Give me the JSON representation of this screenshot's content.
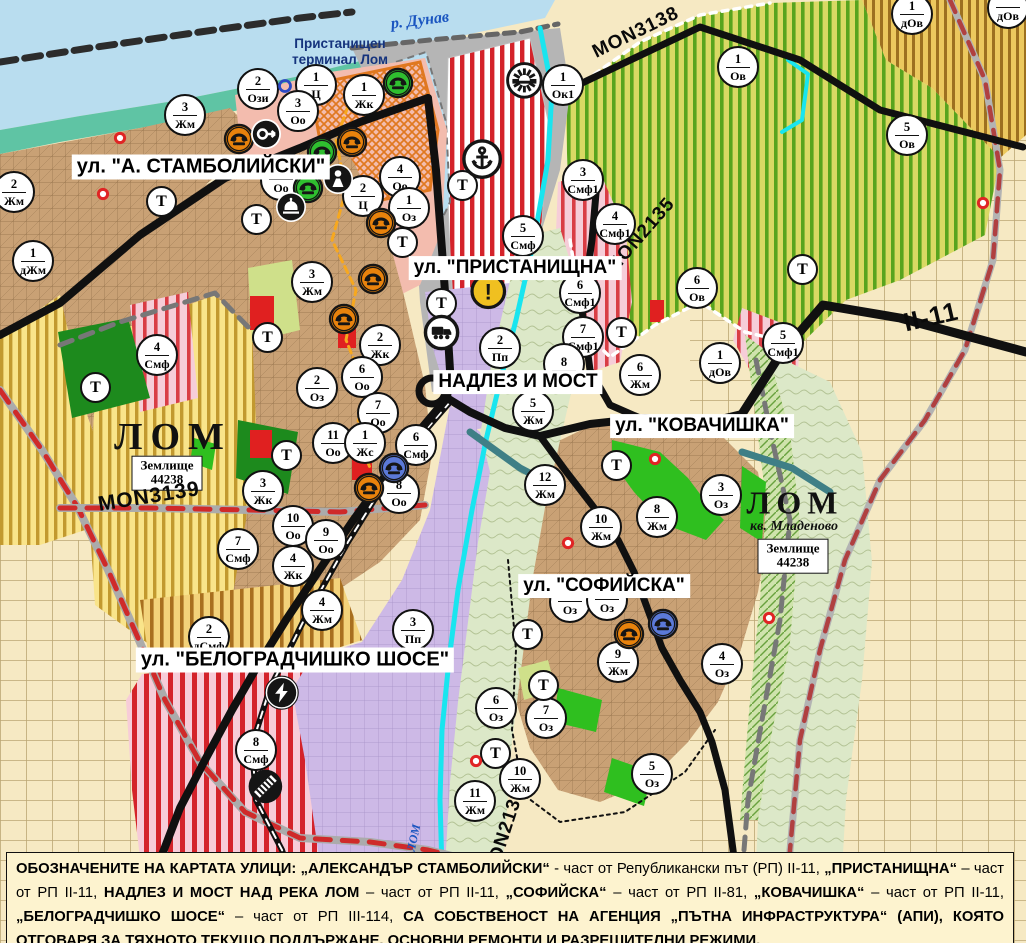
{
  "map": {
    "water_labels": {
      "danube": "р. Дунав",
      "lom_river": "ЛОМ"
    },
    "terminal_label": {
      "line1": "Пристанищен",
      "line2": "терминал Лом"
    },
    "street_labels": [
      {
        "text": "ул. \"А. СТАМБОЛИЙСКИ\"",
        "x": 201,
        "y": 167,
        "fs": 20
      },
      {
        "text": "ул. \"ПРИСТАНИЩНА\"",
        "x": 515,
        "y": 268,
        "fs": 19
      },
      {
        "text": "НАДЛЕЗ И МОСТ",
        "x": 518,
        "y": 382,
        "fs": 19
      },
      {
        "text": "ул. \"КОВАЧИШКА\"",
        "x": 702,
        "y": 426,
        "fs": 19
      },
      {
        "text": "ул. \"СОФИЙСКА\"",
        "x": 604,
        "y": 586,
        "fs": 19
      },
      {
        "text": "ул. \"БЕЛОГРАДЧИШКО ШОСЕ\"",
        "x": 295,
        "y": 660,
        "fs": 20
      }
    ],
    "road_labels": [
      {
        "text": "MON3139",
        "x": 149,
        "y": 497,
        "rot": -9,
        "fs": 21
      },
      {
        "text": "MON3138",
        "x": 636,
        "y": 33,
        "rot": -26,
        "fs": 19
      },
      {
        "text": "MON2135",
        "x": 641,
        "y": 236,
        "rot": -49,
        "fs": 19
      },
      {
        "text": "II-11",
        "x": 931,
        "y": 317,
        "rot": -13,
        "fs": 26
      },
      {
        "text": "MON2136",
        "x": 505,
        "y": 833,
        "rot": -72,
        "fs": 19
      }
    ],
    "city_west": {
      "name": "ЛОМ",
      "land_line1": "Землище",
      "land_line2": "44238"
    },
    "city_east": {
      "name": "ЛОМ",
      "district": "кв. Младеново",
      "land_line1": "Землище",
      "land_line2": "44238"
    },
    "zone_markers": [
      {
        "n": "2",
        "code": "Ози",
        "x": 258,
        "y": 89
      },
      {
        "n": "1",
        "code": "Ц",
        "x": 316,
        "y": 85
      },
      {
        "n": "3",
        "code": "Оо",
        "x": 298,
        "y": 111
      },
      {
        "n": "1",
        "code": "Жк",
        "x": 364,
        "y": 95
      },
      {
        "n": "3",
        "code": "Жм",
        "x": 185,
        "y": 115
      },
      {
        "n": "2",
        "code": "Жм",
        "x": 14,
        "y": 192
      },
      {
        "n": "1",
        "code": "дЖм",
        "x": 33,
        "y": 261
      },
      {
        "n": "",
        "code": "Оо",
        "x": 281,
        "y": 180
      },
      {
        "n": "4",
        "code": "Оо",
        "x": 400,
        "y": 177
      },
      {
        "n": "2",
        "code": "Ц",
        "x": 363,
        "y": 196
      },
      {
        "n": "1",
        "code": "Оз",
        "x": 409,
        "y": 208
      },
      {
        "n": "1",
        "code": "Ок1",
        "x": 563,
        "y": 85
      },
      {
        "n": "1",
        "code": "дОв",
        "x": 912,
        "y": 14
      },
      {
        "n": "",
        "code": "дОв",
        "x": 1008,
        "y": 8
      },
      {
        "n": "1",
        "code": "Ов",
        "x": 738,
        "y": 67
      },
      {
        "n": "5",
        "code": "Ов",
        "x": 907,
        "y": 135
      },
      {
        "n": "3",
        "code": "Смф1",
        "x": 583,
        "y": 180
      },
      {
        "n": "4",
        "code": "Смф1",
        "x": 615,
        "y": 224
      },
      {
        "n": "5",
        "code": "Смф",
        "x": 523,
        "y": 236
      },
      {
        "n": "6",
        "code": "Смф1",
        "x": 580,
        "y": 293
      },
      {
        "n": "7",
        "code": "Смф1",
        "x": 583,
        "y": 337
      },
      {
        "n": "6",
        "code": "Ов",
        "x": 697,
        "y": 288
      },
      {
        "n": "1",
        "code": "дОв",
        "x": 720,
        "y": 363
      },
      {
        "n": "5",
        "code": "Смф1",
        "x": 783,
        "y": 343
      },
      {
        "n": "3",
        "code": "Жм",
        "x": 312,
        "y": 282
      },
      {
        "n": "2",
        "code": "Жк",
        "x": 380,
        "y": 345
      },
      {
        "n": "2",
        "code": "Оз",
        "x": 317,
        "y": 388
      },
      {
        "n": "6",
        "code": "Оо",
        "x": 362,
        "y": 377
      },
      {
        "n": "7",
        "code": "Оо",
        "x": 378,
        "y": 413
      },
      {
        "n": "11",
        "code": "Оо",
        "x": 333,
        "y": 443
      },
      {
        "n": "1",
        "code": "Жс",
        "x": 365,
        "y": 443
      },
      {
        "n": "6",
        "code": "Смф",
        "x": 416,
        "y": 445
      },
      {
        "n": "8",
        "code": "Оо",
        "x": 399,
        "y": 493
      },
      {
        "n": "3",
        "code": "Жк",
        "x": 263,
        "y": 491
      },
      {
        "n": "10",
        "code": "Оо",
        "x": 293,
        "y": 526
      },
      {
        "n": "9",
        "code": "Оо",
        "x": 326,
        "y": 540
      },
      {
        "n": "4",
        "code": "Жк",
        "x": 293,
        "y": 566
      },
      {
        "n": "7",
        "code": "Смф",
        "x": 238,
        "y": 549
      },
      {
        "n": "4",
        "code": "Смф",
        "x": 157,
        "y": 355
      },
      {
        "n": "2",
        "code": "Пп",
        "x": 500,
        "y": 348
      },
      {
        "n": "8",
        "code": "",
        "x": 564,
        "y": 364
      },
      {
        "n": "5",
        "code": "Жм",
        "x": 533,
        "y": 411
      },
      {
        "n": "12",
        "code": "Жм",
        "x": 545,
        "y": 485
      },
      {
        "n": "10",
        "code": "Жм",
        "x": 601,
        "y": 527
      },
      {
        "n": "8",
        "code": "Жм",
        "x": 657,
        "y": 517
      },
      {
        "n": "6",
        "code": "Жм",
        "x": 640,
        "y": 375
      },
      {
        "n": "3",
        "code": "Оз",
        "x": 721,
        "y": 495
      },
      {
        "n": "10",
        "code": "Жм",
        "x": 520,
        "y": 779
      },
      {
        "n": "11",
        "code": "Жм",
        "x": 475,
        "y": 801
      },
      {
        "n": "9",
        "code": "Жм",
        "x": 618,
        "y": 662
      },
      {
        "n": "6",
        "code": "Оз",
        "x": 496,
        "y": 708
      },
      {
        "n": "7",
        "code": "Оз",
        "x": 546,
        "y": 718
      },
      {
        "n": "5",
        "code": "Оз",
        "x": 652,
        "y": 774
      },
      {
        "n": "4",
        "code": "Оз",
        "x": 722,
        "y": 664
      },
      {
        "n": "8",
        "code": "Смф",
        "x": 256,
        "y": 750
      },
      {
        "n": "2",
        "code": "дСмф",
        "x": 209,
        "y": 637
      },
      {
        "n": "4",
        "code": "Жм",
        "x": 322,
        "y": 610
      },
      {
        "n": "3",
        "code": "Пп",
        "x": 413,
        "y": 630
      },
      {
        "n": "",
        "code": "Оз",
        "x": 570,
        "y": 602
      },
      {
        "n": "",
        "code": "Оз",
        "x": 607,
        "y": 600
      }
    ],
    "t_markers": [
      {
        "x": 162,
        "y": 202
      },
      {
        "x": 257,
        "y": 220
      },
      {
        "x": 403,
        "y": 243
      },
      {
        "x": 463,
        "y": 186
      },
      {
        "x": 442,
        "y": 304
      },
      {
        "x": 268,
        "y": 338
      },
      {
        "x": 96,
        "y": 388
      },
      {
        "x": 287,
        "y": 456
      },
      {
        "x": 622,
        "y": 333
      },
      {
        "x": 803,
        "y": 270
      },
      {
        "x": 617,
        "y": 466
      },
      {
        "x": 528,
        "y": 635
      },
      {
        "x": 544,
        "y": 686
      },
      {
        "x": 496,
        "y": 754
      }
    ],
    "icons": [
      {
        "kind": "monument",
        "color": "orange",
        "x": 239,
        "y": 139
      },
      {
        "kind": "monument",
        "color": "orange",
        "x": 352,
        "y": 142
      },
      {
        "kind": "monument",
        "color": "orange",
        "x": 381,
        "y": 223
      },
      {
        "kind": "monument",
        "color": "orange",
        "x": 373,
        "y": 279
      },
      {
        "kind": "monument",
        "color": "orange",
        "x": 344,
        "y": 319
      },
      {
        "kind": "monument",
        "color": "orange",
        "x": 369,
        "y": 488
      },
      {
        "kind": "monument",
        "color": "orange",
        "x": 629,
        "y": 634
      },
      {
        "kind": "monument",
        "color": "green",
        "x": 398,
        "y": 83
      },
      {
        "kind": "monument",
        "color": "green",
        "x": 322,
        "y": 152
      },
      {
        "kind": "monument",
        "color": "green",
        "x": 308,
        "y": 188
      },
      {
        "kind": "monument",
        "color": "blue",
        "x": 394,
        "y": 468
      },
      {
        "kind": "monument",
        "color": "blue",
        "x": 663,
        "y": 624
      },
      {
        "kind": "arrow",
        "x": 266,
        "y": 134
      },
      {
        "kind": "dome",
        "x": 291,
        "y": 207
      },
      {
        "kind": "person",
        "x": 338,
        "y": 179
      },
      {
        "kind": "anchor",
        "x": 482,
        "y": 159,
        "s": 1.3
      },
      {
        "kind": "sun",
        "x": 524,
        "y": 80,
        "s": 1.2
      },
      {
        "kind": "truck",
        "x": 442,
        "y": 333,
        "s": 1.15
      },
      {
        "kind": "lightning",
        "x": 282,
        "y": 693,
        "s": 1.1
      },
      {
        "kind": "railway",
        "x": 265,
        "y": 786,
        "s": 1.2
      },
      {
        "kind": "warning",
        "x": 488,
        "y": 291,
        "s": 1.25
      },
      {
        "kind": "bluering",
        "x": 285,
        "y": 86
      },
      {
        "kind": "reddot",
        "x": 120,
        "y": 138
      },
      {
        "kind": "reddot",
        "x": 103,
        "y": 194
      },
      {
        "kind": "reddot",
        "x": 568,
        "y": 543
      },
      {
        "kind": "reddot",
        "x": 655,
        "y": 459
      },
      {
        "kind": "reddot",
        "x": 476,
        "y": 761
      },
      {
        "kind": "reddot",
        "x": 983,
        "y": 203
      },
      {
        "kind": "reddot",
        "x": 769,
        "y": 618
      }
    ]
  },
  "note": {
    "segments": [
      {
        "t": "ОБОЗНАЧЕНИТЕ НА КАРТАТА УЛИЦИ: „АЛЕКСАНДЪР СТАМБОЛИЙСКИ“",
        "b": true
      },
      {
        "t": " - част от Републикански път (РП) II-11, ",
        "b": false
      },
      {
        "t": "„ПРИСТАНИЩНА“",
        "b": true
      },
      {
        "t": " – част от РП II-11, ",
        "b": false
      },
      {
        "t": "НАДЛЕЗ И МОСТ НАД РЕКА ЛОМ",
        "b": true
      },
      {
        "t": " – част от РП II-11, ",
        "b": false
      },
      {
        "t": "„СОФИЙСКА“",
        "b": true
      },
      {
        "t": " – част от РП II-81, ",
        "b": false
      },
      {
        "t": "„КОВАЧИШКА“",
        "b": true
      },
      {
        "t": " – част от РП II-11, ",
        "b": false
      },
      {
        "t": "„БЕЛОГРАДЧИШКО ШОСЕ“",
        "b": true
      },
      {
        "t": " – част от РП III-114, ",
        "b": false
      },
      {
        "t": "СА СОБСТВЕНОСТ НА АГЕНЦИЯ „ПЪТНА ИНФРАСТРУКТУРА“ (АПИ), КОЯТО ОТГОВАРЯ ЗА ТЯХНОТО ТЕКУЩО ПОДДЪРЖАНЕ, ОСНОВНИ РЕМОНТИ И РАЗРЕШИТЕЛНИ РЕЖИМИ.",
        "b": true
      }
    ]
  },
  "palette": {
    "water": "#b9ddef",
    "shore": "#5fc4a4",
    "port_gray": "#b5b5b5",
    "town": "#c9a175",
    "agri_yellow": "#f9e48a",
    "agri_stripe": "#b98c1e",
    "vine_bg": "#d9d964",
    "vine_green": "#58a41e",
    "red_stripe": "#d4232a",
    "pink_center": "#f3bcae",
    "lavender": "#cdb9e6",
    "floodplain": "#dde9c9",
    "sage": "#dce8c8",
    "green_oz": "#2fbf1f",
    "park_dark": "#1d8a1d",
    "road_black": "#101010",
    "boundary_red": "#cf2a2a",
    "river_cyan": "#19e5ef",
    "cream": "#f6e9c3",
    "note_bg": "#fdf3cf",
    "marker_orange": "#e8820c",
    "marker_green": "#2fbf2f",
    "marker_blue": "#5b79d8",
    "warning_yellow": "#f0c020",
    "terminal_orange": "#e07820"
  }
}
